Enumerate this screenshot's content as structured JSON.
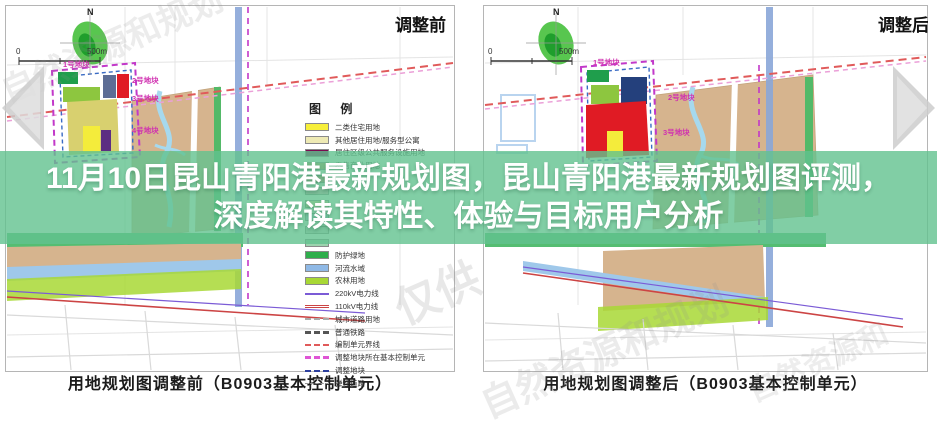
{
  "title": {
    "line1": "11月10日昆山青阳港最新规划图，昆山青阳港最新规划图评测，",
    "line2": "深度解读其特性、体验与目标用户分析"
  },
  "carousel": {
    "prev_icon": "left-arrow",
    "next_icon": "right-arrow",
    "arrow_color": "#c9c9c9"
  },
  "maps": [
    {
      "corner_label": "调整前",
      "caption": "用地规划图调整前（B0903基本控制单元）",
      "north_label": "N",
      "scale_zero": "0",
      "scale_label": "500m",
      "parcel_labels": [
        "1号地块",
        "2号地块",
        "3号地块",
        "4号地块"
      ]
    },
    {
      "corner_label": "调整后",
      "caption": "用地规划图调整后（B0903基本控制单元）",
      "north_label": "N",
      "scale_zero": "0",
      "scale_label": "500m",
      "parcel_labels": [
        "1号地块",
        "2号地块",
        "3号地块"
      ]
    }
  ],
  "legend": {
    "header": "图  例",
    "items": [
      {
        "label": "二类住宅用地",
        "kind": "fill",
        "color": "#f7ef3a"
      },
      {
        "label": "其他居住用地/服务型公寓",
        "kind": "fill",
        "color": "#eeeab4"
      },
      {
        "label": "居住区级公共服务设施用地",
        "kind": "fill",
        "color": "#7b0a50"
      },
      {
        "label": "零售商业用地",
        "kind": "fill",
        "color": "#c39a6b"
      },
      {
        "label": "",
        "kind": "fill",
        "color": "#d98f80"
      },
      {
        "label": "",
        "kind": "fill",
        "color": "#e8b6c8"
      },
      {
        "label": "",
        "kind": "fill",
        "color": "#f0d9a0"
      },
      {
        "label": "",
        "kind": "fill",
        "color": "#b8cfe8"
      },
      {
        "label": "",
        "kind": "fill",
        "color": "#cfcfcf"
      },
      {
        "label": "",
        "kind": "fill",
        "color": "#9cd3ae"
      },
      {
        "label": "防护绿地",
        "kind": "fill",
        "color": "#2fae4c"
      },
      {
        "label": "河流水域",
        "kind": "fill",
        "color": "#8fb9e6"
      },
      {
        "label": "农林用地",
        "kind": "fill",
        "color": "#a8d835"
      },
      {
        "label": "220kV电力线",
        "kind": "line",
        "color": "#7b5bd6",
        "line_style": "solid",
        "weight": 2
      },
      {
        "label": "110kV电力线",
        "kind": "line",
        "color": "#cc4444",
        "line_style": "double",
        "weight": 3
      },
      {
        "label": "城市道路用地",
        "kind": "line",
        "color": "#aaaaaa",
        "line_style": "dashed",
        "weight": 2
      },
      {
        "label": "普通铁路",
        "kind": "line",
        "color": "#555555",
        "line_style": "dashed",
        "weight": 3
      },
      {
        "label": "编制单元界线",
        "kind": "line",
        "color": "#e05a5a",
        "line_style": "dashed",
        "weight": 2
      },
      {
        "label": "调整地块所在基本控制单元",
        "kind": "line",
        "color": "#df55d5",
        "line_style": "dashed",
        "weight": 3
      },
      {
        "label": "调整地块",
        "kind": "line",
        "color": "#2c3f9e",
        "line_style": "dashed",
        "weight": 2
      },
      {
        "label": "弹性道路",
        "kind": "line",
        "color": "#999999",
        "line_style": "dashed",
        "weight": 1
      }
    ]
  },
  "watermarks": [
    "自然资源和规划",
    "仅供",
    "自然资源和规划",
    "自然资源和"
  ],
  "colors": {
    "band_green": "rgba(97,194,143,0.8)",
    "farmland_tan": "#d6b48e",
    "canal_blue": "#8aa6d8",
    "stream_blue": "#a6d9ee",
    "green_belt": "#53b968",
    "agri_green": "#a8d835",
    "parcel_red": "#e01b24",
    "parcel_yellow": "#f4ec3b",
    "parcel_lime": "#8dc63f",
    "parcel_navy": "#24407c",
    "parcel_purple": "#5c2d82",
    "boundary_magenta": "#c238c9"
  }
}
